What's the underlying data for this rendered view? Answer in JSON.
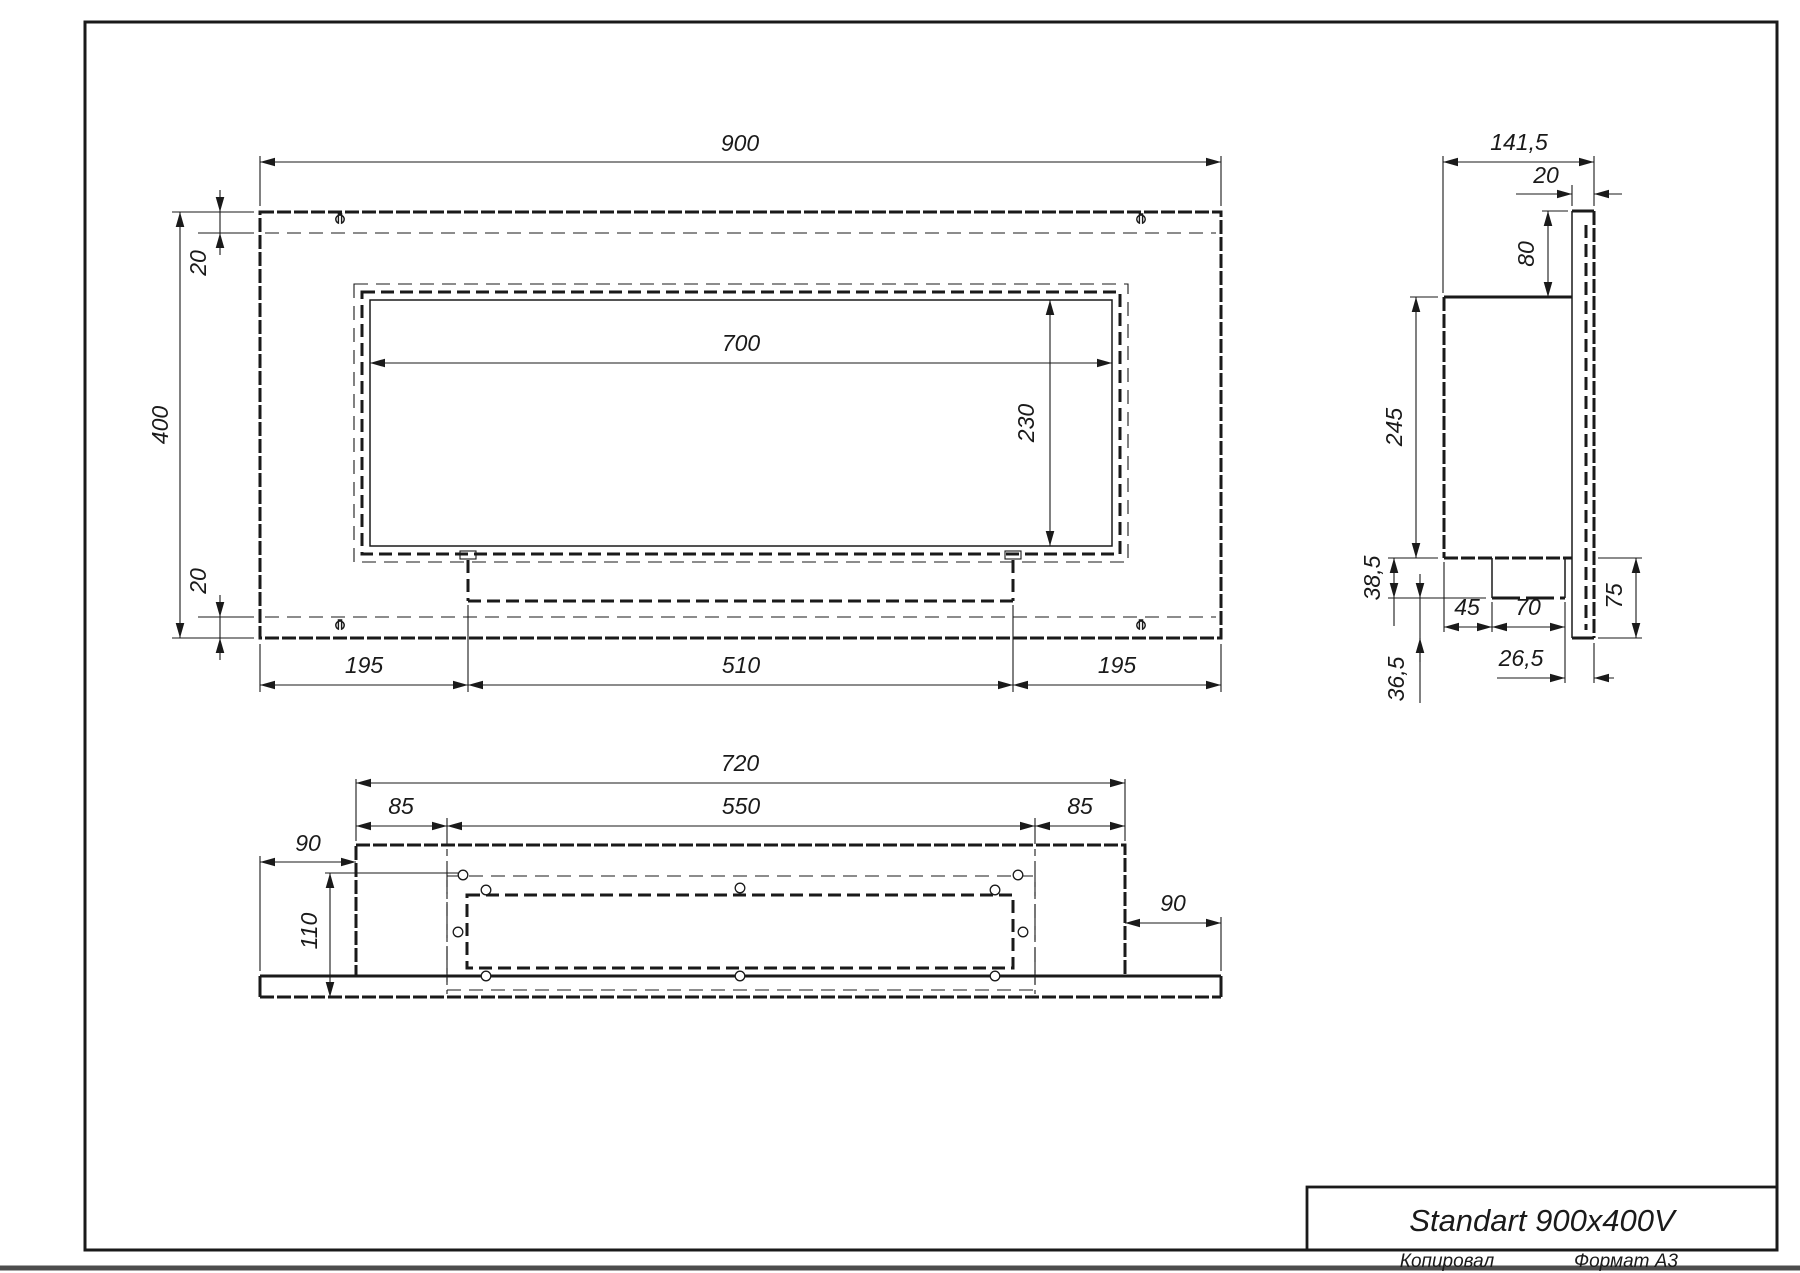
{
  "title_block": {
    "title": "Standart 900x400V",
    "copied_by": "Копировал",
    "format": "Формат А3"
  },
  "front_view": {
    "overall_width": "900",
    "overall_height": "400",
    "top_inset": "20",
    "bottom_inset": "20",
    "opening_width": "700",
    "opening_height": "230",
    "foot_left": "195",
    "foot_center": "510",
    "foot_right": "195"
  },
  "side_view": {
    "overall_depth": "141,5",
    "flange_depth": "20",
    "flange_height": "80",
    "body_height": "245",
    "tray_height": "38,5",
    "tray_offset": "45",
    "tray_width": "70",
    "front_wall_height": "75",
    "front_gap": "26,5",
    "lower_drop": "36,5"
  },
  "top_view": {
    "body_width": "720",
    "inset_left": "85",
    "slot_width": "550",
    "inset_right": "85",
    "wing_left": "90",
    "wing_right": "90",
    "body_depth": "110"
  }
}
